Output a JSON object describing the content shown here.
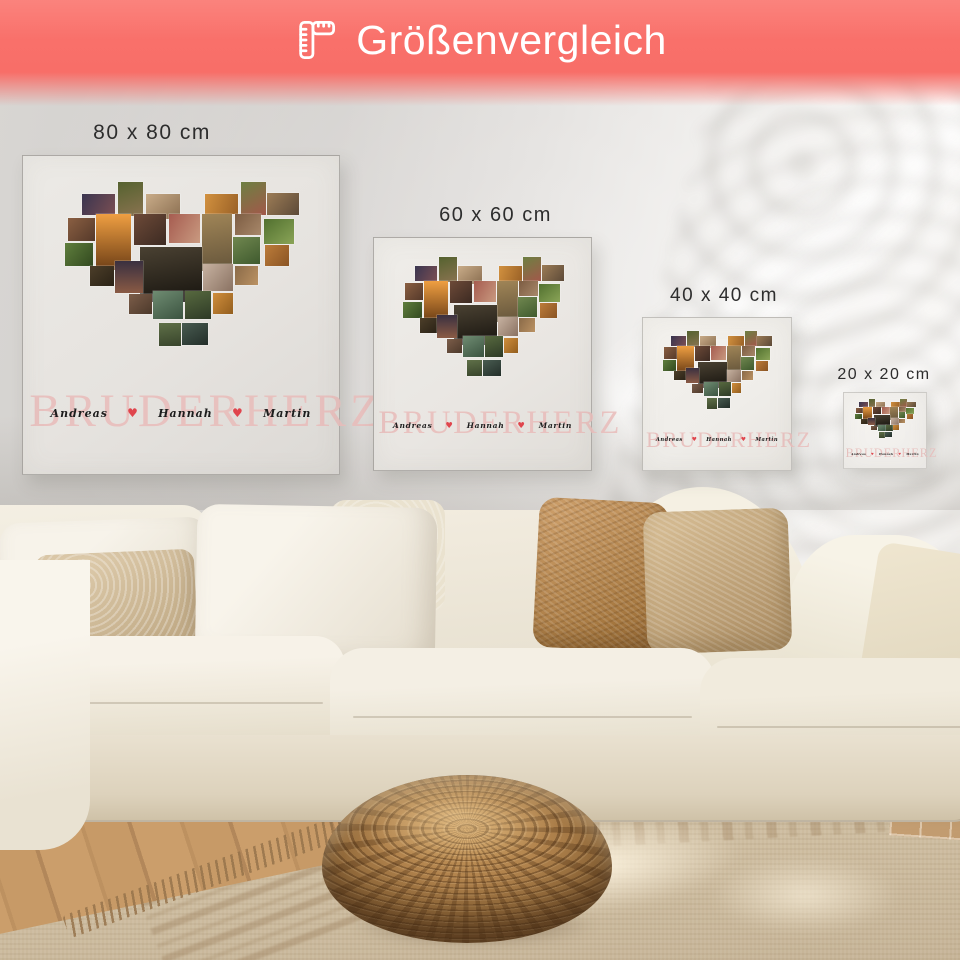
{
  "banner": {
    "title": "Größenvergleich",
    "icon": "folding-ruler-icon",
    "background_color": "#f9706a",
    "text_color": "#ffffff"
  },
  "size_labels": [
    {
      "label": "80 x 80 cm"
    },
    {
      "label": "60 x 60 cm"
    },
    {
      "label": "40 x 40 cm"
    },
    {
      "label": "20 x 20 cm"
    }
  ],
  "canvas_print": {
    "title_word": "BRUDERHERZ",
    "title_color": "#e9bcba",
    "names": [
      "Andreas",
      "Hannah",
      "Martin"
    ],
    "names_color": "#1d1d1d",
    "heart_separator": "♥",
    "heart_color": "#e0454d",
    "collage_shape": "heart",
    "collage_tiles": [
      {
        "x": 9.5,
        "y": 7.5,
        "w": 13.5,
        "h": 10.5,
        "c1": "#3a3550",
        "c2": "#7a4e52",
        "a": 120
      },
      {
        "x": 24,
        "y": 2,
        "w": 10.5,
        "h": 16.5,
        "c1": "#55622f",
        "c2": "#8a7350",
        "a": 160
      },
      {
        "x": 35.5,
        "y": 7.5,
        "w": 14,
        "h": 12,
        "c1": "#c9ac89",
        "c2": "#8a6e50",
        "a": 140
      },
      {
        "x": 60,
        "y": 7.5,
        "w": 13.5,
        "h": 10,
        "c1": "#d2913f",
        "c2": "#9a6126",
        "a": 110
      },
      {
        "x": 74.5,
        "y": 2,
        "w": 10.5,
        "h": 16,
        "c1": "#6d8042",
        "c2": "#a2584a",
        "a": 150
      },
      {
        "x": 85.5,
        "y": 7,
        "w": 13,
        "h": 11,
        "c1": "#9c7c56",
        "c2": "#5d4a38",
        "a": 130
      },
      {
        "x": 3.5,
        "y": 19,
        "w": 11,
        "h": 11.5,
        "c1": "#8a5f42",
        "c2": "#55392a",
        "a": 135
      },
      {
        "x": 15,
        "y": 17.5,
        "w": 14.5,
        "h": 27,
        "c1": "#ef9f42",
        "c2": "#6e3f16",
        "a": 180
      },
      {
        "x": 30.5,
        "y": 17.5,
        "w": 13.5,
        "h": 15,
        "c1": "#6d4a38",
        "c2": "#3c2a22",
        "a": 140
      },
      {
        "x": 45,
        "y": 17.5,
        "w": 13,
        "h": 14,
        "c1": "#a65c50",
        "c2": "#c99a80",
        "a": 120
      },
      {
        "x": 58.5,
        "y": 17.5,
        "w": 12.5,
        "h": 27.5,
        "c1": "#a08557",
        "c2": "#64543a",
        "a": 170
      },
      {
        "x": 72,
        "y": 17.5,
        "w": 11,
        "h": 10,
        "c1": "#7c5c42",
        "c2": "#a8886a",
        "a": 130
      },
      {
        "x": 84,
        "y": 19.5,
        "w": 12.5,
        "h": 12.5,
        "c1": "#51702f",
        "c2": "#8aa457",
        "a": 140
      },
      {
        "x": 2.5,
        "y": 31.5,
        "w": 11.5,
        "h": 11,
        "c1": "#5f7e3d",
        "c2": "#32491f",
        "a": 130
      },
      {
        "x": 33,
        "y": 33.5,
        "w": 25.5,
        "h": 26.5,
        "c1": "#4a4132",
        "c2": "#16130e",
        "a": 170
      },
      {
        "x": 71.5,
        "y": 28.5,
        "w": 11,
        "h": 13,
        "c1": "#70874f",
        "c2": "#3f5a2e",
        "a": 150
      },
      {
        "x": 84.5,
        "y": 32.5,
        "w": 10,
        "h": 10,
        "c1": "#bc7c3a",
        "c2": "#8a5424",
        "a": 130
      },
      {
        "x": 12.5,
        "y": 42.5,
        "w": 10,
        "h": 9.5,
        "c1": "#4c3e29",
        "c2": "#2a2216",
        "a": 140
      },
      {
        "x": 23,
        "y": 40,
        "w": 11.5,
        "h": 15.5,
        "c1": "#3a3040",
        "c2": "#8a5a44",
        "a": 180
      },
      {
        "x": 59,
        "y": 41.5,
        "w": 12.5,
        "h": 13,
        "c1": "#c7b2a1",
        "c2": "#8a7262",
        "a": 130
      },
      {
        "x": 72,
        "y": 42.5,
        "w": 9.5,
        "h": 9,
        "c1": "#8a6a48",
        "c2": "#bb9263",
        "a": 120
      },
      {
        "x": 28.5,
        "y": 56,
        "w": 9.5,
        "h": 9.5,
        "c1": "#7c5d49",
        "c2": "#4c392b",
        "a": 140
      },
      {
        "x": 38.5,
        "y": 54.5,
        "w": 12.5,
        "h": 13.5,
        "c1": "#6f8c72",
        "c2": "#3b5340",
        "a": 150
      },
      {
        "x": 51.5,
        "y": 54.5,
        "w": 11,
        "h": 13.5,
        "c1": "#57693f",
        "c2": "#2e3a26",
        "a": 160
      },
      {
        "x": 63,
        "y": 55.5,
        "w": 8.5,
        "h": 10,
        "c1": "#d08e3c",
        "c2": "#935e1e",
        "a": 130
      },
      {
        "x": 41,
        "y": 70,
        "w": 9,
        "h": 11,
        "c1": "#5f7048",
        "c2": "#38442b",
        "a": 170
      },
      {
        "x": 50.5,
        "y": 70,
        "w": 10.5,
        "h": 10.5,
        "c1": "#495c51",
        "c2": "#232e29",
        "a": 150
      }
    ]
  }
}
